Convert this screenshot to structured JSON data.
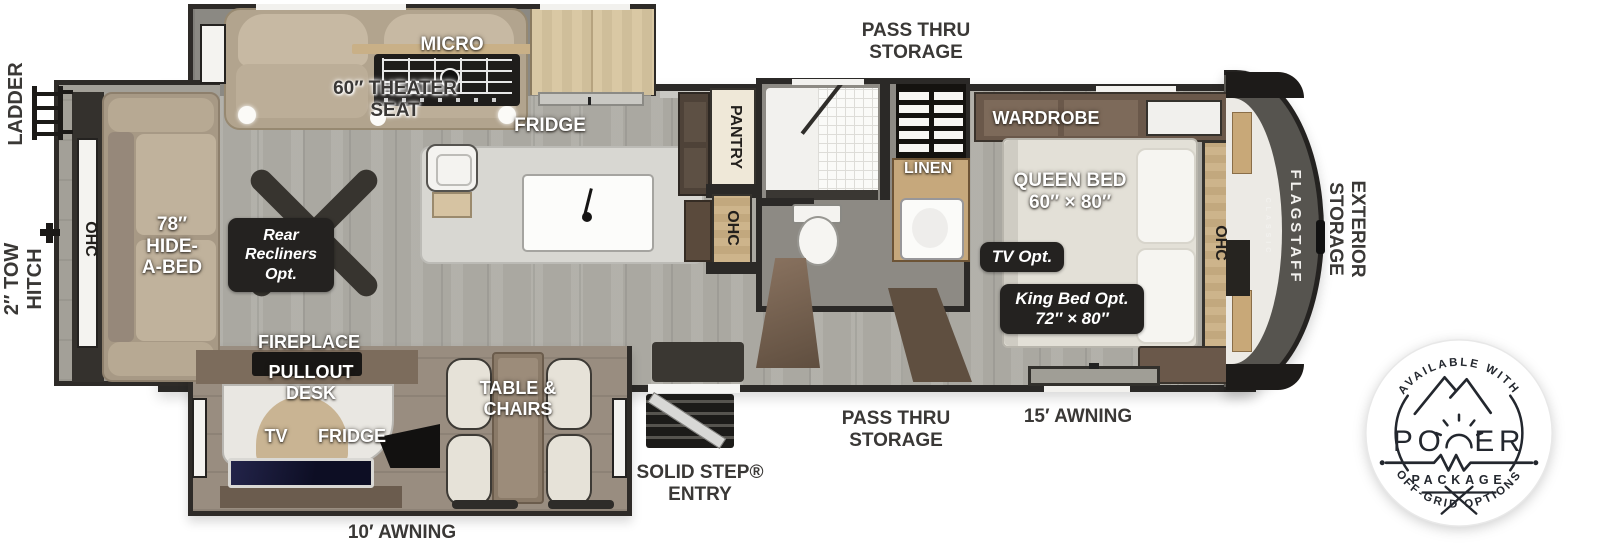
{
  "labels": {
    "ladder": "LADDER",
    "tow_hitch": "2″ TOW\nHITCH",
    "ohc_rear": "OHC",
    "hide_a_bed": "78″\nHIDE-\nA-BED",
    "theater_seat": "60″ THEATER\nSEAT",
    "recliners_opt": "Rear\nRecliners\nOpt.",
    "micro": "MICRO",
    "fridge": "FRIDGE",
    "pantry": "PANTRY",
    "ohc_kitchen": "OHC",
    "pass_thru_top": "PASS THRU\nSTORAGE",
    "linen": "LINEN",
    "wardrobe": "WARDROBE",
    "queen_bed": "QUEEN BED\n60″ × 80″",
    "tv_opt": "TV Opt.",
    "king_bed_opt": "King Bed Opt.\n72″ × 80″",
    "ohc_bedroom": "OHC",
    "flagstaff": "FLAGSTAFF",
    "flagstaff_sub": "CLASSIC",
    "exterior_storage": "EXTERIOR\nSTORAGE",
    "fireplace": "FIREPLACE",
    "pullout_desk": "PULLOUT\nDESK",
    "tv_desk": "TV",
    "fridge_desk": "FRIDGE",
    "table_chairs": "TABLE &\nCHAIRS",
    "awning_10": "10′ AWNING",
    "solid_step": "SOLID STEP®\nENTRY",
    "pass_thru_bottom": "PASS THRU\nSTORAGE",
    "awning_15": "15′ AWNING"
  },
  "badge": {
    "available": "AVAILABLE WITH",
    "power_left": "PO",
    "power_right": "ER",
    "package": "PACKAGE",
    "offgrid": "OFF-GRID OPTIONS"
  },
  "colors": {
    "floor": "#aaa8a1",
    "wall": "#2b2927",
    "label_dark": "#3a3836",
    "label_light": "#ffffff",
    "option_pill": "#242220",
    "badge_ink": "#23272e",
    "cap_gray": "#56544f"
  }
}
